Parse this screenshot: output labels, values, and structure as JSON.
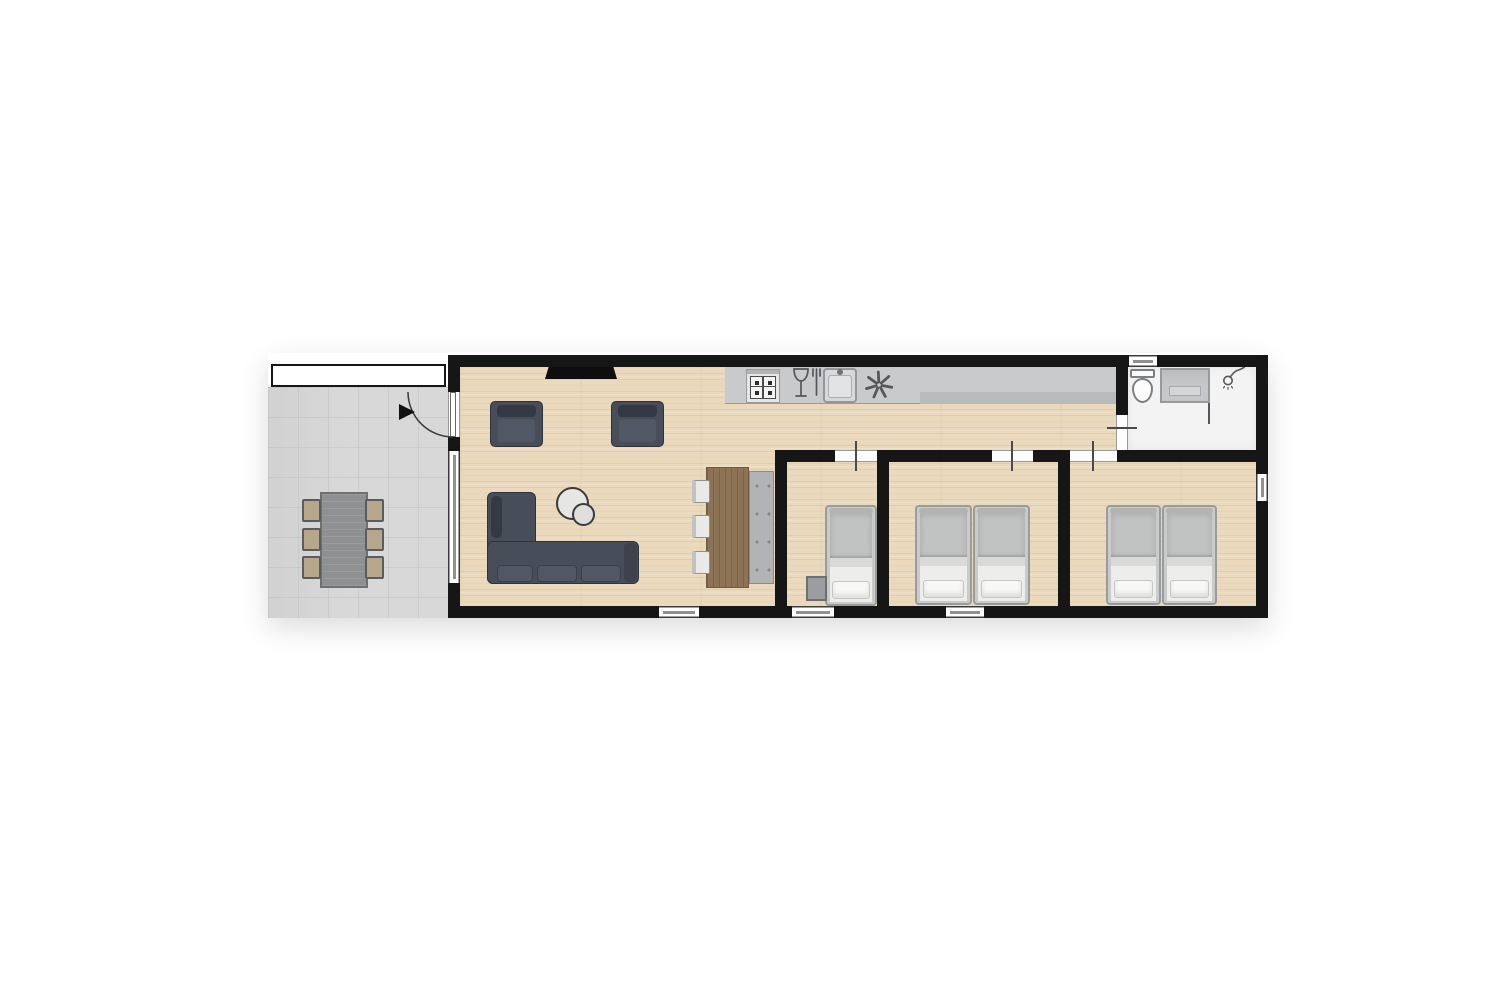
{
  "plan": {
    "title": "Holiday lodge floor plan",
    "type": "2d-top-down-floor-plan",
    "text_on_image": "none"
  },
  "palette": {
    "wall": "#161616",
    "wood": "#ead9bc",
    "terrace": "#d8d8d8",
    "canopy": "#ffffff",
    "counter": "#c9cacb",
    "counterDark": "#b9babb",
    "sofa": "#474d59",
    "sofaDark": "#343a44",
    "sofaSeat": "#505765",
    "tableWood": "#8d7355",
    "bench": "#b1b4b6",
    "chairSeatOutdoor": "#b7a78a",
    "chairFrameOutdoor": "#595c60",
    "chairIndoor": "#e9e9e7",
    "bedFrame": "#c9cbca",
    "bedDuvet": "#c1c3c2",
    "bedBand": "#d9dad8",
    "mattress": "#edeeec",
    "pillow": "#f8f8f6",
    "nightstand": "#9b9d9f",
    "bathFloor": "#f3f3f3",
    "fixture": "#c6c7c9",
    "outline": "#55575a",
    "windowLine": "#8e9092",
    "tv": "#0e0e0e",
    "arcStroke": "#3a3a3a"
  },
  "rooms": [
    {
      "id": "terrace",
      "label": "Terrace with outdoor dining table and 6 chairs"
    },
    {
      "id": "living-room",
      "label": "Living room with TV, 2 armchairs, corner sofa, side tables, dining table with bench and 3 chairs"
    },
    {
      "id": "kitchen",
      "label": "Kitchen counter with stove, dishwasher, sink and extractor"
    },
    {
      "id": "bedroom-1",
      "label": "Bedroom 1 with single bed and nightstand"
    },
    {
      "id": "bedroom-2",
      "label": "Bedroom 2 with two single beds"
    },
    {
      "id": "bedroom-3",
      "label": "Bedroom 3 with two single beds"
    },
    {
      "id": "bathroom",
      "label": "Bathroom with toilet and shower"
    }
  ],
  "icons": [
    "stove-icon",
    "dishwasher-icon",
    "sink-icon",
    "extractor-fan-icon",
    "shower-head-icon",
    "toilet-icon",
    "entrance-arrow-icon",
    "door-swing-icon"
  ],
  "counts": {
    "bedrooms": 3,
    "single_beds": 5,
    "outdoor_chairs": 6,
    "indoor_dining_chairs": 3,
    "armchairs": 2,
    "windows": 6,
    "interior_doors": 4,
    "entrance_doors": 1
  }
}
